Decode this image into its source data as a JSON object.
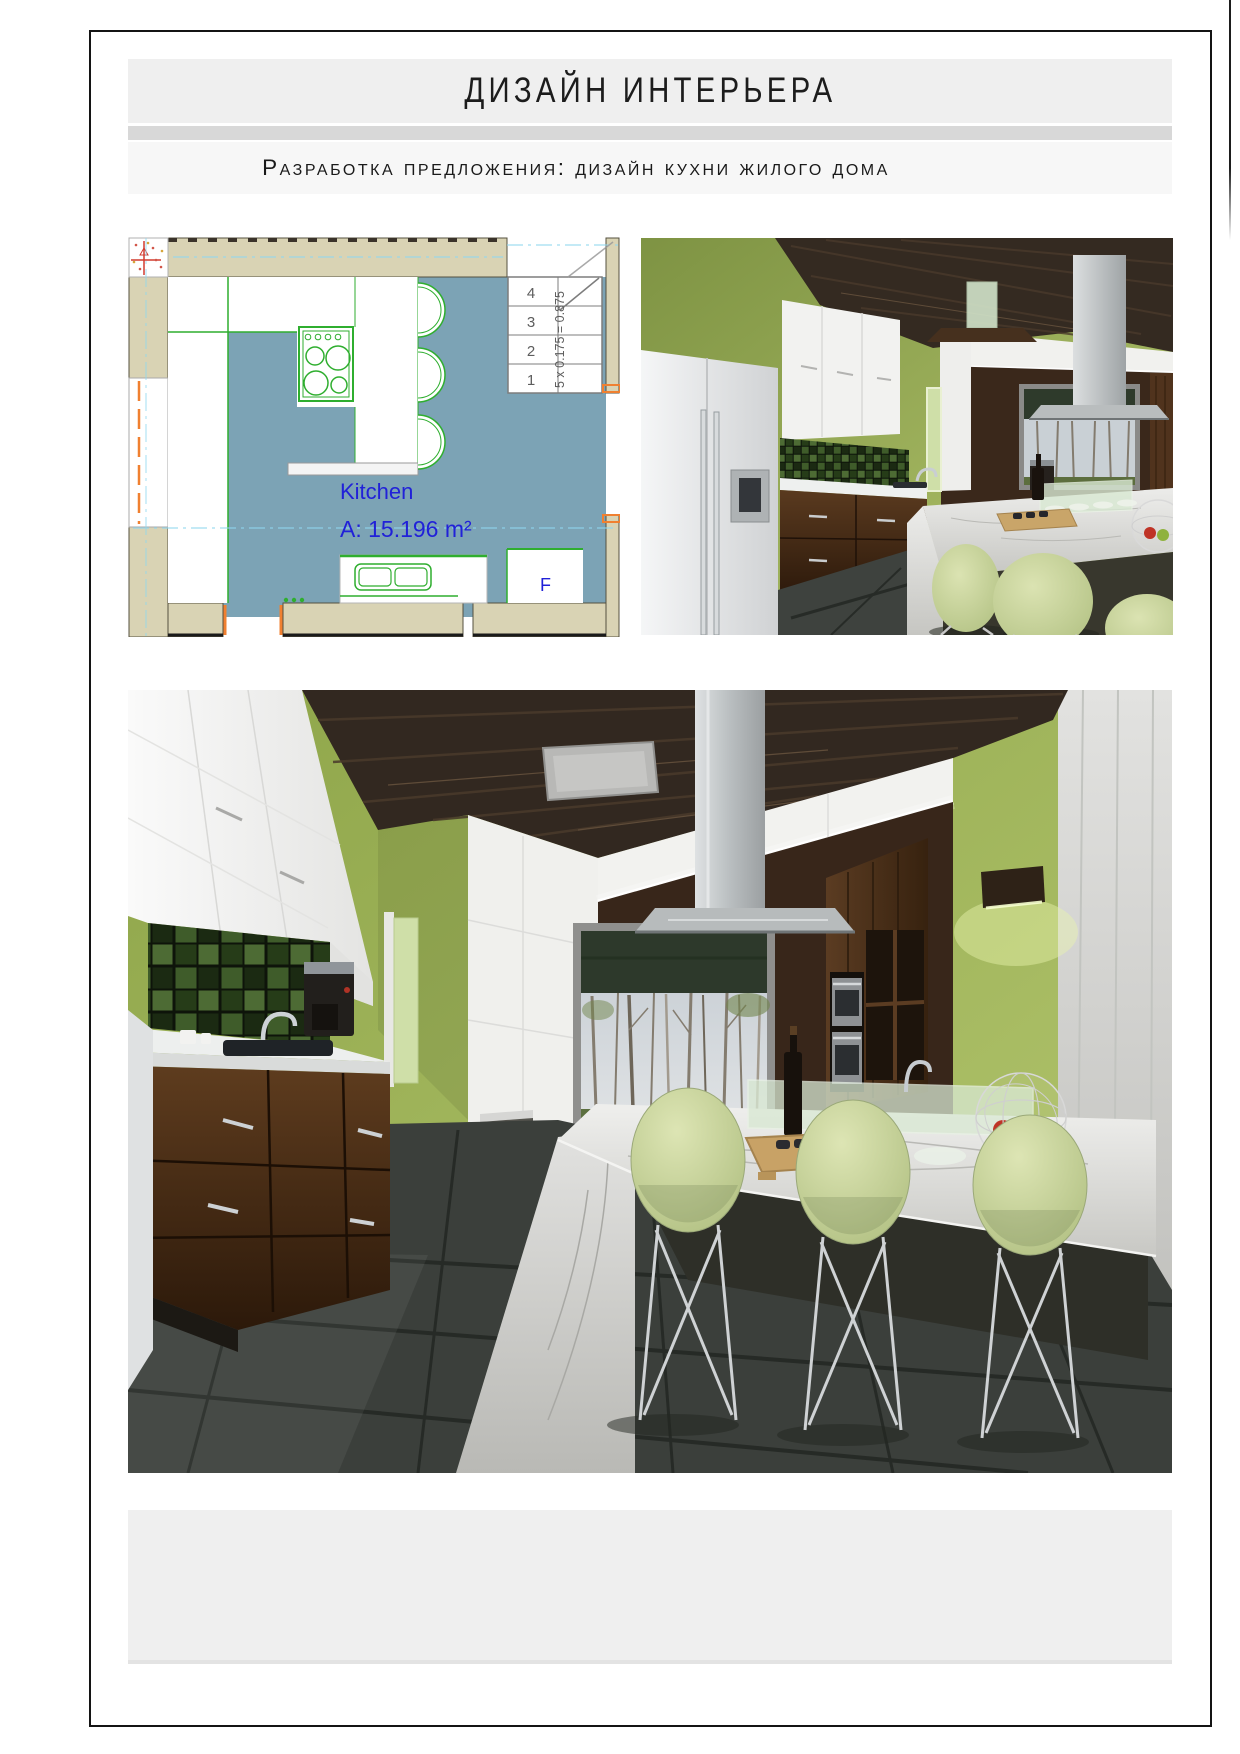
{
  "page": {
    "background": "#ffffff",
    "border_color": "#141414"
  },
  "header": {
    "title": "ДИЗАЙН ИНТЕРЬЕРА",
    "subtitle": "Разработка предложения: дизайн кухни жилого дома",
    "band_color": "#efefef",
    "divider_color": "#d8d8d8",
    "subtitle_band_color": "#f7f7f7"
  },
  "floor_plan": {
    "room_label": "Kitchen",
    "area_label": "A: 15.196 m²",
    "door_label": "F",
    "stair_table": {
      "rows": [
        "4",
        "3",
        "2",
        "1"
      ],
      "formula": "5 x 0.175 = 0.875"
    },
    "colors": {
      "floor": "#7ca3b5",
      "walls": "#d9d3b4",
      "fixtures": "#2fae2f",
      "labels": "#2121d8",
      "centerlines": "#8fd8f0",
      "openings": "#f08030"
    }
  },
  "renders": {
    "palette": {
      "wall_green": "#a7ba5e",
      "ceiling_wood": "#332921",
      "cabinet_wood": "#4a2d17",
      "marble": "#d8d9d5",
      "chair_green": "#c6d29a",
      "floor_tile": "#3c403c"
    }
  },
  "footer": {
    "band_color": "#efefef"
  }
}
